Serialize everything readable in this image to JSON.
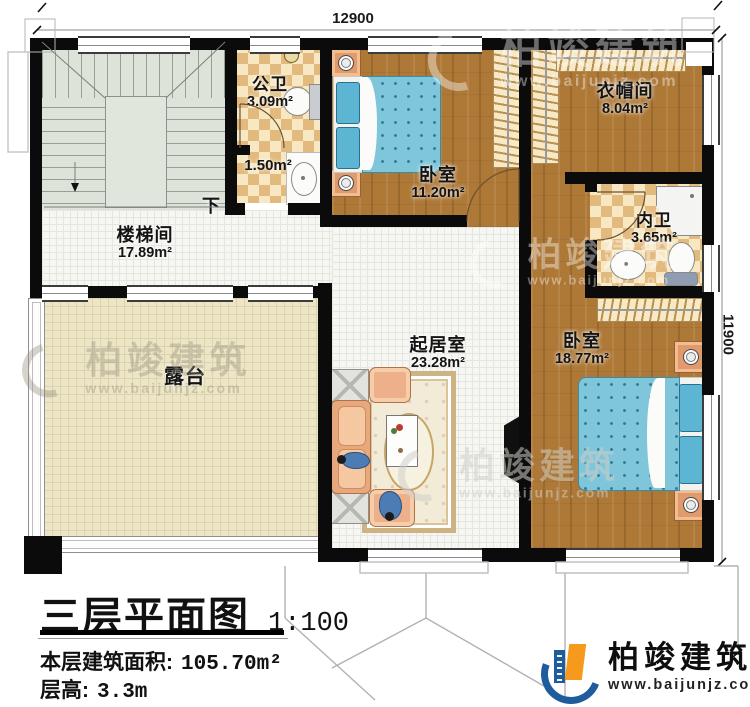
{
  "dimensions": {
    "top": "12900",
    "right": "11900"
  },
  "rooms": {
    "stairwell": {
      "name": "楼梯间",
      "area": "17.89m²"
    },
    "public_bath": {
      "name": "公卫",
      "area": "3.09m²"
    },
    "lobby": {
      "area": "1.50m²"
    },
    "bedroom1": {
      "name": "卧室",
      "area": "11.20m²"
    },
    "cloakroom": {
      "name": "衣帽间",
      "area": "8.04m²"
    },
    "inner_bath": {
      "name": "内卫",
      "area": "3.65m²"
    },
    "living_room": {
      "name": "起居室",
      "area": "23.28m²"
    },
    "bedroom2": {
      "name": "卧室",
      "area": "18.77m²"
    },
    "terrace": {
      "name": "露台"
    }
  },
  "stairs": {
    "down_label": "下"
  },
  "title_block": {
    "title": "三层平面图",
    "scale": "1:100",
    "area_label": "本层建筑面积:",
    "area_value": "105.70m²",
    "floor_height_label": "层高:",
    "floor_height_value": "3.3m"
  },
  "brand": {
    "name": "柏竣建筑",
    "url": "www.baijunjz.com"
  },
  "watermark": {
    "name": "柏竣建筑",
    "url": "www.baijunjz.com"
  },
  "colors": {
    "wall": "#0b0b0b",
    "wood_floor": "#ae7836",
    "bath_checker": "#e3ba7e",
    "bed_blue": "#7fc6da",
    "terrace": "#ece5c6",
    "brand_blue": "#1e5c9e",
    "brand_orange": "#f59a1d"
  }
}
